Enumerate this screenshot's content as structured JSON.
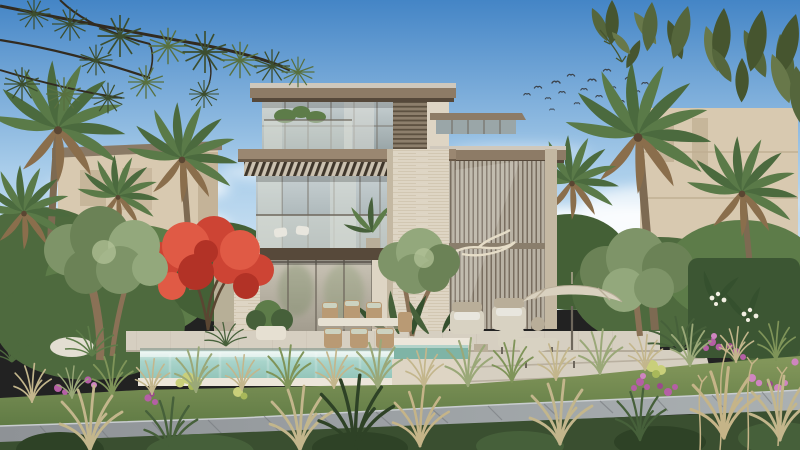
{
  "scene": {
    "type": "architectural-exterior-render",
    "subject": "modern three-storey luxury villa with garden and pool",
    "elements": [
      "sky",
      "clouds",
      "bird-flock",
      "palm-trees",
      "pine-branches",
      "overhanging-leaves",
      "neighbor-villas",
      "main-villa",
      "pergola",
      "louver-screen",
      "stone-pier",
      "balcony",
      "swimming-pool",
      "spa",
      "pool-deck",
      "outdoor-dining-set",
      "armchair-set",
      "sun-loungers",
      "patio-umbrella",
      "flame-tree",
      "olive-trees",
      "garden-hedge",
      "flower-beds",
      "ornamental-grasses",
      "grass-bank",
      "stone-path",
      "foreground-plants"
    ]
  },
  "palette": {
    "sky_top": "#4485c6",
    "sky_mid": "#a9cdea",
    "sky_low": "#e3f0f8",
    "cloud": "#ffffff",
    "bird": "#3c434b",
    "pine_branch": "#322b20",
    "pine_needle": "#3c4e2f",
    "pine_needle_light": "#58703f",
    "leaf_dark": "#46552f",
    "leaf_mid": "#55663c",
    "leaf_light": "#68784a",
    "neighbor_wall": "#d8c9b0",
    "neighbor_roof": "#8a7a66",
    "neighbor_shade": "#bfae92",
    "roof_top": "#cfc8bc",
    "roof_face": "#8d7b66",
    "roof_under": "#55483a",
    "fascia": "#9a8771",
    "fascia_shadow": "#6b5b49",
    "glass_hi": "#c6cfd1",
    "glass_lo": "#9aa6a8",
    "glass_warm_hi": "#c9c3b5",
    "glass_warm_lo": "#a29c8e",
    "mullion": "#6e675c",
    "curtain": "#dcdfd8",
    "screen_slat": "#5c5040",
    "screen_bg": "#8d7f6c",
    "travertine": "#ded5c4",
    "travertine_line": "#c9bda6",
    "travertine_shade": "#c4b8a2",
    "pergola_bg": "#cbc1b0",
    "pergola_slat": "#3f362b",
    "louver_bg": "#b9b2a4",
    "louver_line": "#6e6254",
    "louver_rail": "#8a7e6c",
    "soffit": "#57493a",
    "branch_sculpt": "#e6ddc8",
    "deck": "#d6cfc1",
    "deck_line": "#b9b0a0",
    "deck_shadow": "#a89f8e",
    "coping": "#ece6da",
    "pool_hi": "#e6f2ee",
    "pool_mid": "#a9d4cb",
    "pool_lo": "#8fc2b6",
    "spa": "#7fb4a6",
    "pool_shadow": "#6f8a80",
    "grass_hi": "#85985c",
    "grass_lo": "#5f7a44",
    "grass_dark": "#3a4f30",
    "bush_dark": "#2e4226",
    "bush_mid": "#46603a",
    "bush_light": "#5d7c49",
    "shrub1": "#4e6a3e",
    "shrub2": "#5d7c49",
    "shrub3": "#446036",
    "olive1": "#7e9468",
    "olive2": "#6b8256",
    "olive3": "#93a87c",
    "olive_hi": "#b5c49a",
    "trunk": "#8a7156",
    "trunk_dark": "#5a4632",
    "palm_a": "#5a7a48",
    "palm_b": "#4b6a3e",
    "palm_dry": "#8a6e4c",
    "palm_trunk": "#7d6a52",
    "flame1": "#cd4434",
    "flame2": "#b23226",
    "flame3": "#e05a45",
    "hedge": "#3c5633",
    "frang_leaf": "#35502e",
    "flower_white": "#f2efe2",
    "purple1": "#b55fa5",
    "purple2": "#cf85c0",
    "purple3": "#9a4a8c",
    "euphorbia": "#c9cf7a",
    "euphorbia2": "#a8b85a",
    "tuft_tan": "#c3b68c",
    "tuft_sage": "#9aa878",
    "tuft_green": "#7f9459",
    "plume": "#c5b488",
    "path_a": "#8e9296",
    "path_b": "#aab0b2",
    "path_line": "#767a7e",
    "path_edge": "#c9cdd0",
    "furniture": "#d8d2c2",
    "furniture_dark": "#b9ae99",
    "cushion": "#e8e6de",
    "wicker": "#b99a74",
    "cushion_sage": "#ccd2c0",
    "metal": "#6e675c",
    "umbrella": "#d9d1bf",
    "umbrella_rib": "#b9ae99",
    "boulder": "#e3ded2",
    "pot_white": "#e6e0d2"
  }
}
